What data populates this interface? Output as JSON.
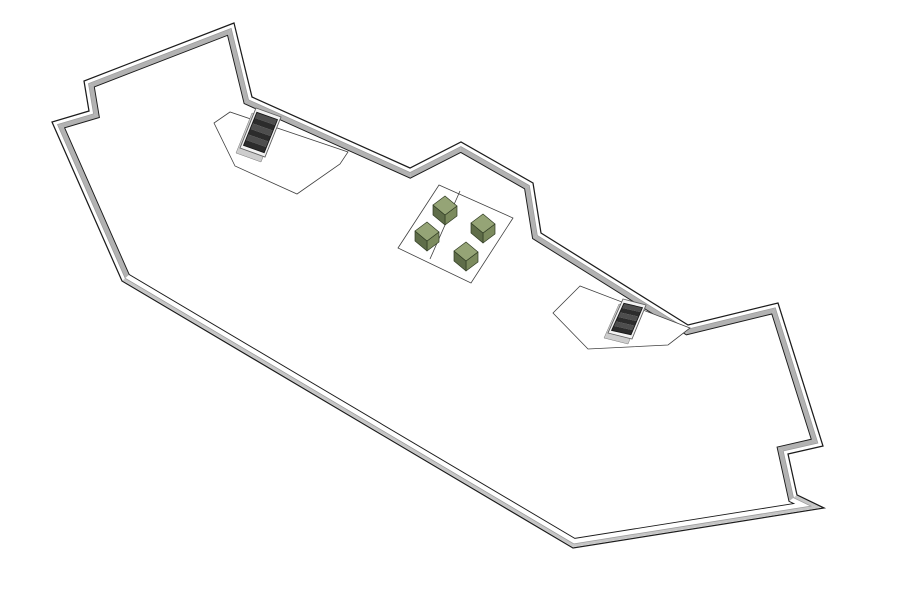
{
  "app": {
    "name": "3d-roof-plan-model-view",
    "background": "#ffffff"
  },
  "model": {
    "canvas": {
      "width": 898,
      "height": 602
    },
    "colors": {
      "background": "#ffffff",
      "outline": "#1c1c1c",
      "inner_line": "#1c1c1c",
      "mid_line": "#9b9b9b",
      "wall_inner_face": "#b2b2b2",
      "wall_outer_face": "#c6c6c6",
      "floor": "#ffffff",
      "platform_fill": "#ffffff",
      "platform_stroke": "#404040",
      "stair_frame_fill": "#f2f2f2",
      "stair_frame_stroke": "#606060",
      "stair_well_stroke": "#161616",
      "stair_tread_dark": "#2c2c2c",
      "stair_tread_light": "#4e4e4e",
      "stair_curb_shadow": "#cdcdcd",
      "stair_curb_stroke": "#777777",
      "box_top": "#95a476",
      "box_side_dark": "#5f6d49",
      "box_side_mid": "#7c8b5e",
      "box_stroke": "#2e3a22"
    },
    "roof": {
      "outline": [
        [
          234,
          23
        ],
        [
          252,
          97
        ],
        [
          410,
          168
        ],
        [
          461,
          142
        ],
        [
          533,
          183
        ],
        [
          541,
          233
        ],
        [
          688,
          325
        ],
        [
          778,
          303
        ],
        [
          823,
          446
        ],
        [
          788,
          454
        ],
        [
          797,
          495
        ],
        [
          824,
          508
        ],
        [
          573,
          548
        ],
        [
          122,
          281
        ],
        [
          52,
          122
        ],
        [
          89,
          111
        ],
        [
          84,
          81
        ]
      ],
      "wall_band": {
        "outer_inset": 0.8,
        "mid_offset": 4.0,
        "inner_offset": 9.2,
        "near_edges": [
          10,
          11,
          12
        ]
      }
    },
    "platforms": [
      {
        "name": "stair-platform-upper",
        "points": [
          [
            230,
            112
          ],
          [
            214,
            123
          ],
          [
            235,
            166
          ],
          [
            297,
            194
          ],
          [
            340,
            164
          ],
          [
            348,
            152
          ]
        ]
      },
      {
        "name": "stair-platform-right",
        "points": [
          [
            580,
            286
          ],
          [
            553,
            313
          ],
          [
            588,
            349
          ],
          [
            668,
            345
          ],
          [
            690,
            328
          ]
        ]
      },
      {
        "name": "seating-platform",
        "points": [
          [
            439,
            185
          ],
          [
            513,
            218
          ],
          [
            471,
            283
          ],
          [
            398,
            248
          ]
        ],
        "divider": [
          [
            460,
            191
          ],
          [
            430,
            259
          ]
        ]
      }
    ],
    "stairs": [
      {
        "name": "stair-opening-upper",
        "quad": [
          [
            256,
            108
          ],
          [
            281,
            117
          ],
          [
            265,
            157
          ],
          [
            240,
            148
          ]
        ],
        "treads": 6,
        "well_inset": 4.4,
        "shadow_dx": -4,
        "shadow_dy": 5
      },
      {
        "name": "stair-opening-right",
        "quad": [
          [
            623,
            299
          ],
          [
            646,
            305
          ],
          [
            632,
            339
          ],
          [
            608,
            333
          ]
        ],
        "treads": 6,
        "well_inset": 4.4,
        "shadow_dx": -4,
        "shadow_dy": 5
      }
    ],
    "furniture": {
      "u": [
        12,
        10
      ],
      "v": [
        -12,
        9
      ],
      "h": 10,
      "boxes": [
        {
          "name": "seat-box-1",
          "a": [
            445,
            196
          ]
        },
        {
          "name": "seat-box-2",
          "a": [
            427,
            222
          ]
        },
        {
          "name": "seat-box-3",
          "a": [
            483,
            214
          ]
        },
        {
          "name": "seat-box-4",
          "a": [
            466,
            242
          ]
        }
      ]
    }
  }
}
